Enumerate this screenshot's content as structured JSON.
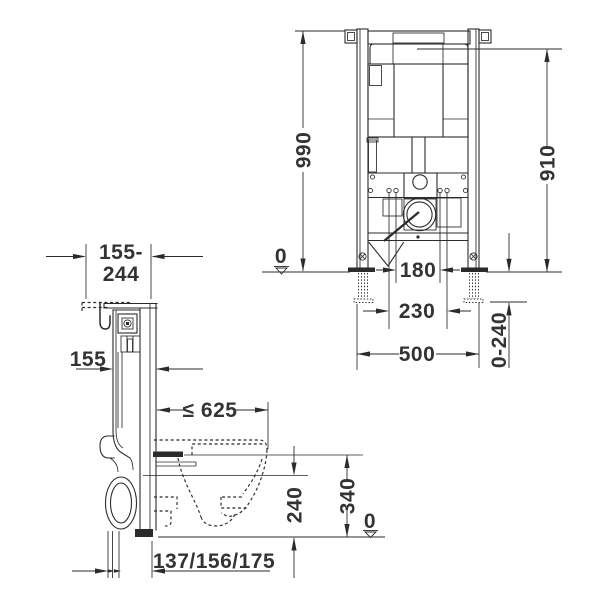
{
  "style": {
    "background": "#ffffff",
    "line_color": "#2b2b2b",
    "text_color": "#333333"
  },
  "side_view": {
    "wall_offset": {
      "line1": "155-",
      "line2": "244"
    },
    "frame_depth": "155",
    "max_installation_depth": "≤ 625",
    "outlet_axis_height": "240",
    "rim_height": "340",
    "outlet_offsets": "137/156/175",
    "floor_datum": "0"
  },
  "front_view": {
    "overall_height": "990",
    "cistern_top_height": "910",
    "fixing_bolt_spacing": "180",
    "foot_spacing": "230",
    "frame_width": "500",
    "foot_adjustment_range": "0-240",
    "floor_datum": "0"
  }
}
